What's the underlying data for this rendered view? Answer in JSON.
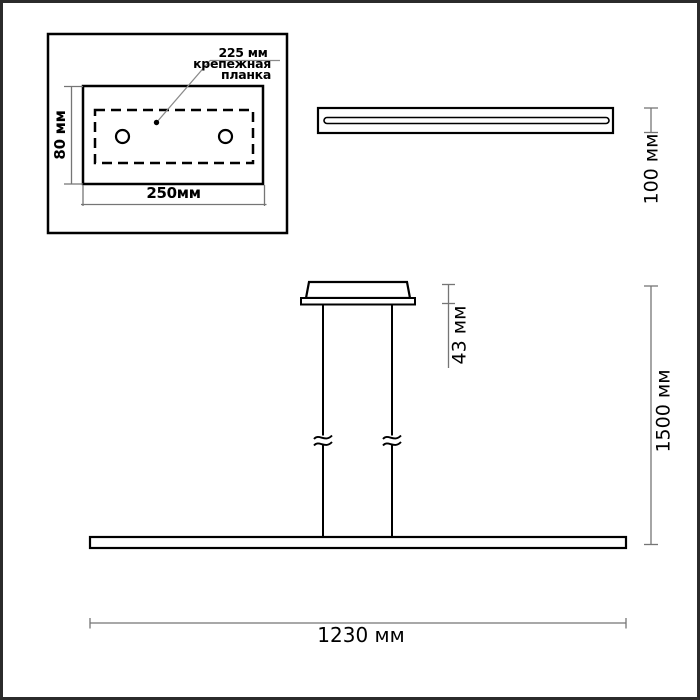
{
  "drawing": {
    "title": "pendant-light-dimension-drawing",
    "colors": {
      "background": "#ffffff",
      "frame": "#2b2b2b",
      "outline_ink": "#000000",
      "dimension_lines": "#757575"
    },
    "inset_top_view": {
      "hole_spacing_label": "225 мм",
      "part_label_line1": "крепежная",
      "part_label_line2": "планка",
      "height_label": "80 мм",
      "width_label": "250мм"
    },
    "side_view": {
      "depth_label": "100 мм"
    },
    "front_view": {
      "canopy_height_label": "43 мм",
      "suspension_length_label": "1500 мм",
      "bar_width_label": "1230 мм"
    }
  }
}
